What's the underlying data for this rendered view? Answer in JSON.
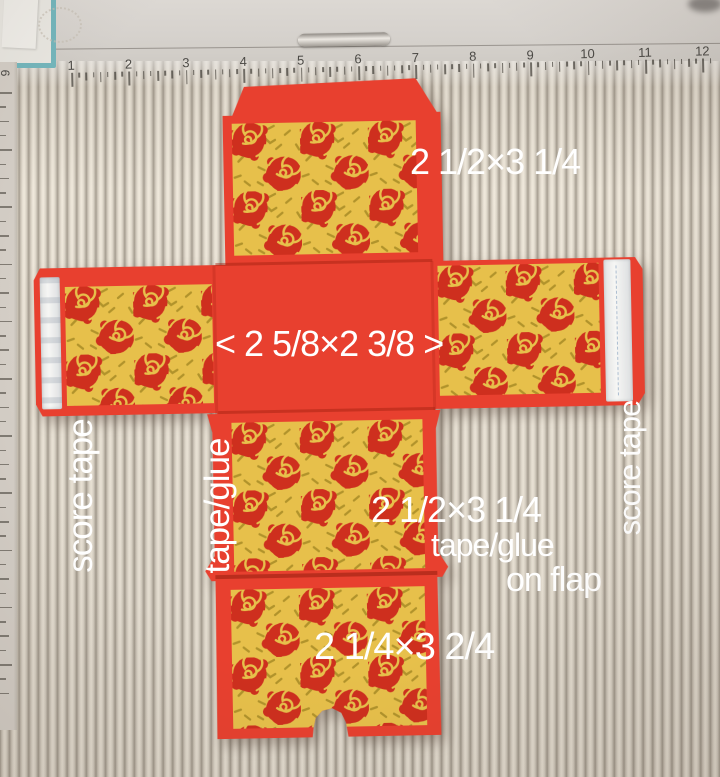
{
  "annotations": {
    "top_size": "2 1/2×3 1/4",
    "center_size": "< 2 5/8×2 3/8 >",
    "left_score_tape": "score tape",
    "left_tape_glue": "tape/glue",
    "middle_size": "2 1/2×3 1/4",
    "flap_note_line1": "tape/glue",
    "flap_note_line2": "on flap",
    "right_score_tape": "score tape",
    "bottom_size": "2 1/4×3 2/4"
  },
  "ruler": {
    "inch_numbers": [
      "1",
      "2",
      "3",
      "4",
      "5",
      "6",
      "7",
      "8",
      "9",
      "10",
      "11",
      "12"
    ],
    "side_number": "9"
  },
  "colors": {
    "cardstock_red": "#e8402f",
    "pattern_yellow": "#e7c04b",
    "rose_red": "#ce2f1e",
    "confetti_olive": "#b1932b",
    "board_light": "#e9e2d5",
    "board_groove": "#a69e91",
    "tape_white": "#f3f4f1",
    "teal_frame": "#74b6bc",
    "text_white": "#ffffff"
  }
}
